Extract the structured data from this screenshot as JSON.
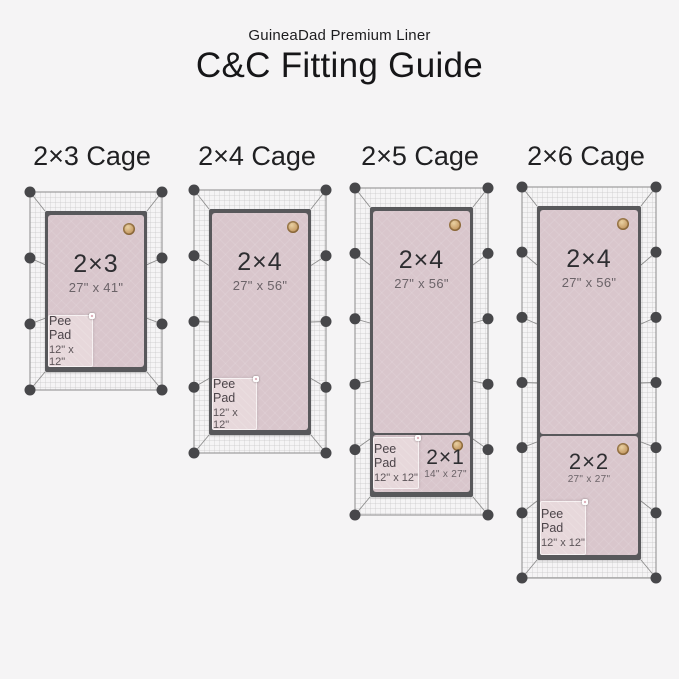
{
  "header": {
    "subtitle": "GuineaDad Premium Liner",
    "title": "C&C Fitting Guide"
  },
  "cages": [
    {
      "label": "2×3 Cage",
      "main": {
        "name": "2×3",
        "dims": "27\" x 41\""
      },
      "pee_pad": {
        "label": "Pee Pad",
        "dims": "12\" x 12\""
      }
    },
    {
      "label": "2×4 Cage",
      "main": {
        "name": "2×4",
        "dims": "27\" x 56\""
      },
      "pee_pad": {
        "label": "Pee Pad",
        "dims": "12\" x 12\""
      }
    },
    {
      "label": "2×5 Cage",
      "main": {
        "name": "2×4",
        "dims": "27\" x 56\""
      },
      "secondary": {
        "name": "2×1",
        "dims": "14\" x 27\""
      },
      "pee_pad": {
        "label": "Pee Pad",
        "dims": "12\" x 12\""
      }
    },
    {
      "label": "2×6 Cage",
      "main": {
        "name": "2×4",
        "dims": "27\" x 56\""
      },
      "secondary": {
        "name": "2×2",
        "dims": "27\" x 27\""
      },
      "pee_pad": {
        "label": "Pee Pad",
        "dims": "12\" x 12\""
      }
    }
  ],
  "icons": {
    "badge": "guineadad-logo-badge",
    "snap": "snap-button",
    "mesh": "cage-wire-mesh"
  },
  "colors": {
    "background": "#f5f4f5",
    "liner_pink": "#d9c6cc",
    "pee_pad_pink": "#e7d8db",
    "frame_gray": "#58585b",
    "connector_gray": "#47474a",
    "badge_gold": "#c9a06a",
    "mesh_line": "#c7c7c7"
  }
}
